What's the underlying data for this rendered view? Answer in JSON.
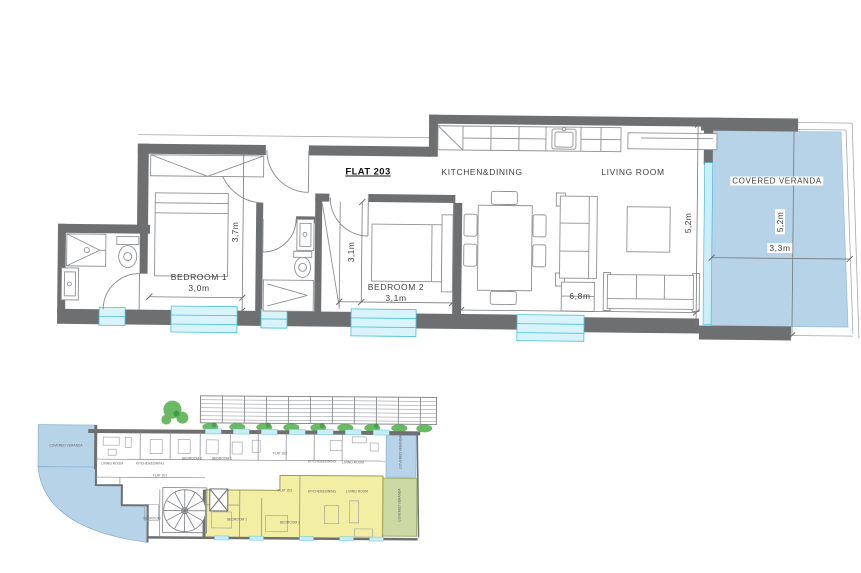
{
  "main_plan": {
    "flat_label": "FLAT 203",
    "kitchen_dining_label": "KITCHEN&DINING",
    "living_room_label": "LIVING ROOM",
    "veranda_label": "COVERED VERANDA",
    "bedroom1_label": "BEDROOM 1",
    "bedroom1_width": "3,0m",
    "bedroom1_depth": "3,7m",
    "bedroom2_label": "BEDROOM 2",
    "bedroom2_width": "3,1m",
    "bedroom2_depth": "3,1m",
    "living_width": "6,8m",
    "living_depth": "5,2m",
    "veranda_width": "3,3m",
    "veranda_depth": "5,2m"
  },
  "site_plan": {
    "highlighted_flat": "FLAT 203",
    "labels": [
      {
        "text": "COVERED VERANDA"
      },
      {
        "text": "LIVING ROOM"
      },
      {
        "text": "KITCHEN&DINING"
      },
      {
        "text": "BEDROOM 2"
      },
      {
        "text": "BEDROOM 1"
      },
      {
        "text": "FLAT 201"
      },
      {
        "text": "FLAT 202"
      },
      {
        "text": "KITCHEN&DINING"
      },
      {
        "text": "LIVING ROOM"
      },
      {
        "text": "COVERED VERANDA"
      },
      {
        "text": "FLAT 203"
      },
      {
        "text": "KITCHEN&DINING"
      },
      {
        "text": "LIVING ROOM"
      },
      {
        "text": "BEDROOM 1"
      },
      {
        "text": "BEDROOM 2"
      },
      {
        "text": "COVERED VERANDA"
      },
      {
        "text": "BEDROOM"
      }
    ]
  },
  "colors": {
    "wall_gray": "#6e6f71",
    "veranda_blue": "#b7d3e8",
    "window_cyan": "#d9f3fb",
    "window_border": "#49c1da",
    "highlight_yellow": "#f1ed9f",
    "veranda_green": "#cbdaa4",
    "landscape_green": "#4fae4a"
  }
}
